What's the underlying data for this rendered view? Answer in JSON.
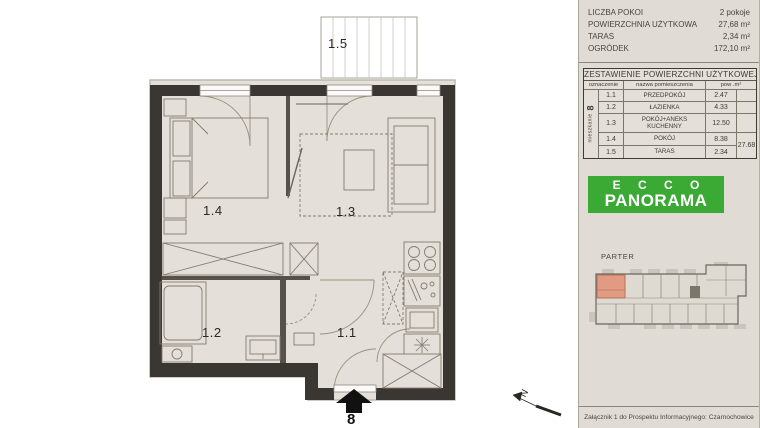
{
  "apartment": {
    "word": "mieszkanie",
    "number": "8"
  },
  "info_panel": {
    "rows": [
      {
        "label": "LICZBA  POKOI",
        "value": "2 pokoje"
      },
      {
        "label": "POWIERZCHNIA UŻYTKOWA",
        "value": "27,68 m²"
      },
      {
        "label": "TARAS",
        "value": "2,34 m²"
      },
      {
        "label": "OGRÓDEK",
        "value": "172,10 m²"
      }
    ]
  },
  "area_table": {
    "title": "ZESTAWIENIE POWIERZCHNI UŻYTKOWEJ",
    "headers": {
      "designation": "oznaczenie",
      "name": "nazwa pomieszczenia",
      "area": "pow .m²"
    },
    "rows": [
      {
        "code": "1.1",
        "name": "PRZEDPOKÓJ",
        "area": "2.47"
      },
      {
        "code": "1.2",
        "name": "ŁAZIENKA",
        "area": "4.33"
      },
      {
        "code": "1.3",
        "name": "POKÓJ+ANEKS KUCHENNY",
        "area": "12.50"
      },
      {
        "code": "1.4",
        "name": "POKÓJ",
        "area": "8.38"
      },
      {
        "code": "1.5",
        "name": "TARAS",
        "area": "2.34"
      }
    ],
    "total": "27.68"
  },
  "brand": {
    "line1": "E C C O",
    "line2": "PANORAMA"
  },
  "overview": {
    "floor_label": "PARTER"
  },
  "plan": {
    "room_labels": [
      "1.1",
      "1.2",
      "1.3",
      "1.4",
      "1.5"
    ],
    "north_label": "N"
  },
  "footer": {
    "caption": "Załącznik 1 do Prospektu Informacyjnego: Czarnochowice"
  },
  "colors": {
    "brand_green": "#3aaa35",
    "highlight_unit": "#e29a82",
    "wall_dark": "#3a3732",
    "floor_beige": "#e4dfd8"
  }
}
